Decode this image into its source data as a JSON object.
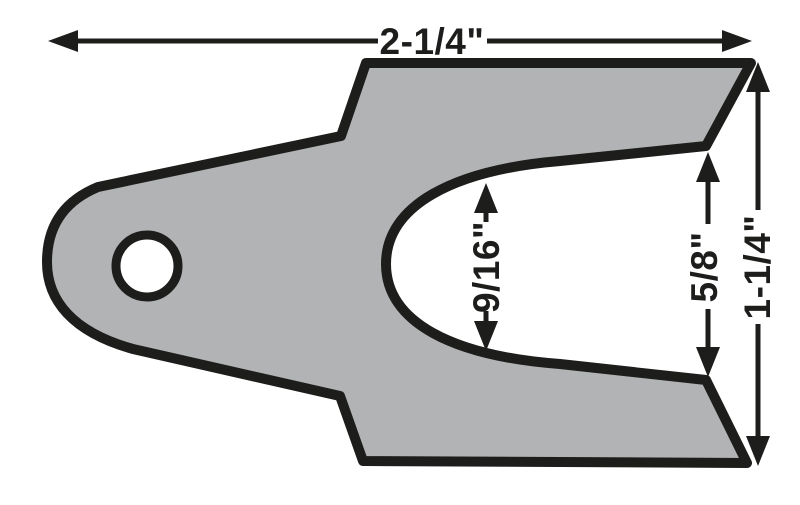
{
  "diagram": {
    "description": "Dimensioned technical drawing of a slotted shim plate with one round mounting hole and a forked slotted end",
    "colors": {
      "background": "#ffffff",
      "part_fill": "#b2b3b5",
      "line": "#1d1d1b"
    },
    "dimensions": {
      "overall_width": {
        "label": "2-1/4\""
      },
      "slot_width": {
        "label": "9/16\""
      },
      "fork_opening": {
        "label": "5/8\""
      },
      "overall_height": {
        "label": "1-1/4\""
      }
    }
  }
}
